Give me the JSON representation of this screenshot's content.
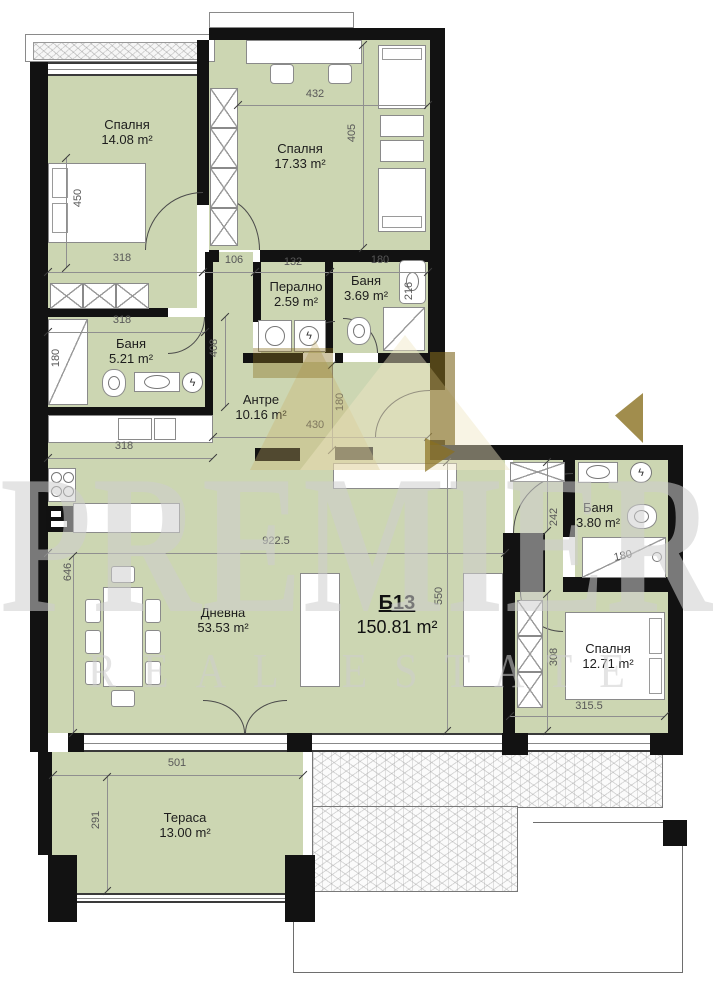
{
  "watermark": {
    "brand": "PREMIER",
    "tagline": "REAL ESTATE"
  },
  "colors": {
    "room_fill": "#ccd6b2",
    "wall": "#121212",
    "logo_gold": "#8a7020",
    "watermark_gray": "#cdcdcd"
  },
  "plan": {
    "unit_code": "Б13",
    "unit_area": "150.81 m²",
    "rooms": [
      {
        "id": "bedroom-1",
        "name": "Спалня",
        "area": "14.08 m²",
        "x": 127,
        "y": 132
      },
      {
        "id": "bedroom-2",
        "name": "Спалня",
        "area": "17.33 m²",
        "x": 300,
        "y": 156
      },
      {
        "id": "laundry",
        "name": "Перално",
        "area": "2.59 m²",
        "x": 296,
        "y": 294
      },
      {
        "id": "bathroom-1",
        "name": "Баня",
        "area": "3.69 m²",
        "x": 366,
        "y": 288
      },
      {
        "id": "bathroom-2",
        "name": "Баня",
        "area": "5.21 m²",
        "x": 131,
        "y": 351
      },
      {
        "id": "hallway",
        "name": "Антре",
        "area": "10.16 m²",
        "x": 261,
        "y": 407
      },
      {
        "id": "living-room",
        "name": "Дневна",
        "area": "53.53 m²",
        "x": 223,
        "y": 620
      },
      {
        "id": "bathroom-3",
        "name": "Баня",
        "area": "3.80 m²",
        "x": 598,
        "y": 515
      },
      {
        "id": "bedroom-3",
        "name": "Спалня",
        "area": "12.71 m²",
        "x": 608,
        "y": 656
      },
      {
        "id": "terrace",
        "name": "Тераса",
        "area": "13.00 m²",
        "x": 185,
        "y": 825
      }
    ],
    "dim_labels": [
      {
        "t": "450",
        "x": 78,
        "y": 198,
        "r": 90
      },
      {
        "t": "318",
        "x": 122,
        "y": 258,
        "r": 0
      },
      {
        "t": "106",
        "x": 234,
        "y": 260,
        "r": 0
      },
      {
        "t": "132",
        "x": 293,
        "y": 262,
        "r": 0
      },
      {
        "t": "180",
        "x": 380,
        "y": 260,
        "r": 0
      },
      {
        "t": "432",
        "x": 315,
        "y": 94,
        "r": 0
      },
      {
        "t": "405",
        "x": 352,
        "y": 133,
        "r": 90
      },
      {
        "t": "216",
        "x": 409,
        "y": 291,
        "r": 90
      },
      {
        "t": "318",
        "x": 122,
        "y": 320,
        "r": 0
      },
      {
        "t": "180",
        "x": 56,
        "y": 358,
        "r": 90
      },
      {
        "t": "408",
        "x": 214,
        "y": 348,
        "r": 90
      },
      {
        "t": "430",
        "x": 315,
        "y": 425,
        "r": 0
      },
      {
        "t": "180",
        "x": 340,
        "y": 402,
        "r": 90
      },
      {
        "t": "318",
        "x": 124,
        "y": 446,
        "r": 0
      },
      {
        "t": "922.5",
        "x": 276,
        "y": 541,
        "r": 0
      },
      {
        "t": "646",
        "x": 68,
        "y": 572,
        "r": 90
      },
      {
        "t": "550",
        "x": 439,
        "y": 596,
        "r": 90
      },
      {
        "t": "242",
        "x": 554,
        "y": 517,
        "r": 90
      },
      {
        "t": "308",
        "x": 554,
        "y": 657,
        "r": 90
      },
      {
        "t": "315.5",
        "x": 589,
        "y": 706,
        "r": 0
      },
      {
        "t": "501",
        "x": 177,
        "y": 763,
        "r": 0
      },
      {
        "t": "291",
        "x": 96,
        "y": 820,
        "r": 90
      },
      {
        "t": "180",
        "x": 623,
        "y": 556,
        "r": 12
      }
    ],
    "dim_lines": [
      {
        "x1": 48,
        "y1": 272,
        "x2": 203,
        "y2": 272
      },
      {
        "x1": 203,
        "y1": 272,
        "x2": 255,
        "y2": 272
      },
      {
        "x1": 255,
        "y1": 272,
        "x2": 330,
        "y2": 272
      },
      {
        "x1": 330,
        "y1": 272,
        "x2": 428,
        "y2": 272
      },
      {
        "x1": 238,
        "y1": 105,
        "x2": 428,
        "y2": 105
      },
      {
        "x1": 363,
        "y1": 45,
        "x2": 363,
        "y2": 248
      },
      {
        "x1": 66,
        "y1": 158,
        "x2": 66,
        "y2": 268
      },
      {
        "x1": 48,
        "y1": 332,
        "x2": 205,
        "y2": 332
      },
      {
        "x1": 225,
        "y1": 317,
        "x2": 225,
        "y2": 407
      },
      {
        "x1": 213,
        "y1": 437,
        "x2": 428,
        "y2": 437
      },
      {
        "x1": 332,
        "y1": 365,
        "x2": 332,
        "y2": 450
      },
      {
        "x1": 48,
        "y1": 458,
        "x2": 213,
        "y2": 458
      },
      {
        "x1": 48,
        "y1": 553,
        "x2": 505,
        "y2": 553
      },
      {
        "x1": 73,
        "y1": 556,
        "x2": 73,
        "y2": 733
      },
      {
        "x1": 447,
        "y1": 462,
        "x2": 447,
        "y2": 731
      },
      {
        "x1": 547,
        "y1": 462,
        "x2": 547,
        "y2": 531
      },
      {
        "x1": 547,
        "y1": 594,
        "x2": 547,
        "y2": 731
      },
      {
        "x1": 510,
        "y1": 716,
        "x2": 665,
        "y2": 716
      },
      {
        "x1": 53,
        "y1": 775,
        "x2": 303,
        "y2": 775
      },
      {
        "x1": 107,
        "y1": 777,
        "x2": 107,
        "y2": 891
      }
    ]
  }
}
